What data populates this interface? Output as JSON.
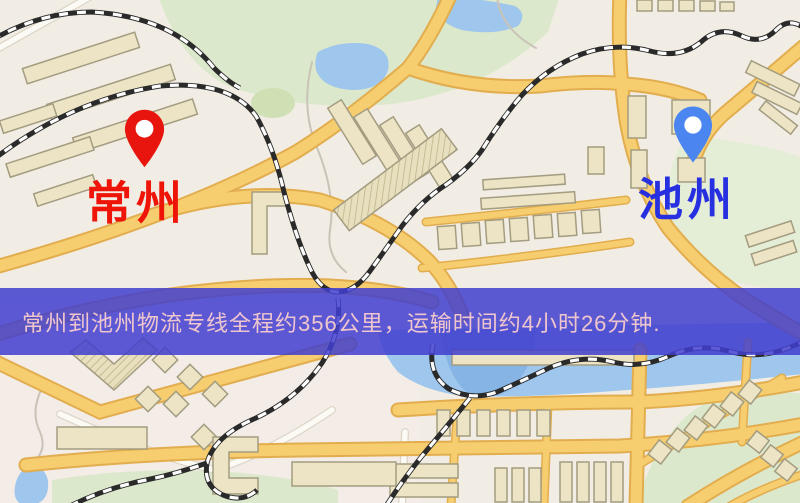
{
  "map": {
    "origin": {
      "label": "常州"
    },
    "destination": {
      "label": "池州"
    }
  },
  "banner": {
    "text": "常州到池州物流专线全程约356公里，运输时间约4小时26分钟."
  },
  "route": {
    "origin": "常州",
    "destination": "池州",
    "distance_text": "约356公里",
    "duration_text": "约4小时26分钟"
  },
  "icons": {
    "origin_pin": "red-map-pin",
    "destination_pin": "blue-map-pin"
  },
  "theme": {
    "map_bg": "#f2ede4",
    "road_yellow": "#f6ce6f",
    "road_casing": "#e2ad4e",
    "park_green": "#dce8cb",
    "water_blue": "#9fc6ec",
    "water_deep": "#86b4e4",
    "building_fill": "#ece4c4",
    "building_stroke": "#a39c80",
    "railway_black": "#2a2a2a",
    "banner_bg": "rgba(65,62,207,0.85)",
    "banner_text": "#f0c6ce",
    "origin_label_color": "#ee1408",
    "dest_label_color": "#2730e0",
    "pin_red": "#e8150f",
    "pin_blue": "#4b86f0"
  }
}
